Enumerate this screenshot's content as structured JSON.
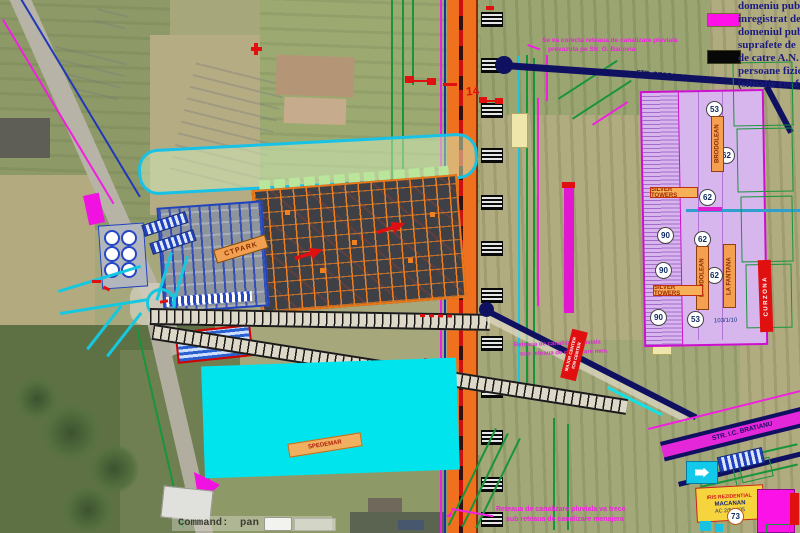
{
  "command": {
    "label": "Command:",
    "value": "pan"
  },
  "legend": {
    "swatch_magenta": "#ff10e8",
    "swatch_black": "#080808",
    "lines": [
      "domeniu publ",
      "inregistrat de",
      "domeniul pub",
      "suprafete de",
      "de catre A.N.",
      "persoane fizic",
      "(situatie conf"
    ]
  },
  "notes": {
    "correction": {
      "line1": "Se va corecta reteaua de canalizare pluviala",
      "line2": "prevazuta pe Str. G. Bacovia"
    },
    "network_mid": {
      "line1": "Reteaua de canalizare pluviala",
      "line2": "sub reteaua de canalizare men."
    },
    "network_bottom": {
      "line1": "Reteaua de canalizare pluviala va trece",
      "line2": "sub reteaua de canalizare menajera"
    }
  },
  "streets": {
    "george_bacovia": "STR. GEORGE BACOVIA",
    "bratianu": "STR. I.C. BRATIANU"
  },
  "labels": {
    "ctpark": "CTPARK",
    "spedemar": "SPEDEMAR",
    "silver_towers": "SILVER TOWERS",
    "curzona": "CURZONA",
    "vertical_1": "BRODOLEAN",
    "vertical_2": "BRODOLEAN",
    "vertical_3": "LA FANTANA",
    "center_red": {
      "line1": "MAJOR CENTER",
      "line2": "ION CENTER"
    },
    "marker_14": "14",
    "parcel_ref": "103/1/10"
  },
  "iris_box": {
    "line1": "IRIS REZIDENTIAL",
    "line2": "MACANAN",
    "line3": "AC 2/5/2005"
  },
  "parcel_numbers": [
    {
      "label": "53"
    },
    {
      "label": "62"
    },
    {
      "label": "62"
    },
    {
      "label": "90"
    },
    {
      "label": "62"
    },
    {
      "label": "90"
    },
    {
      "label": "62"
    },
    {
      "label": "90"
    },
    {
      "label": "53"
    },
    {
      "label": "73"
    }
  ],
  "colors": {
    "highway_orange": "#f0711d",
    "cad_magenta": "#f020e0",
    "cad_cyan": "#15c8e0",
    "cad_green": "#17953a",
    "cad_navy": "#0f1060",
    "parcel_purple": "#d7b6ee",
    "flood_cyan": "#00e4ee"
  }
}
